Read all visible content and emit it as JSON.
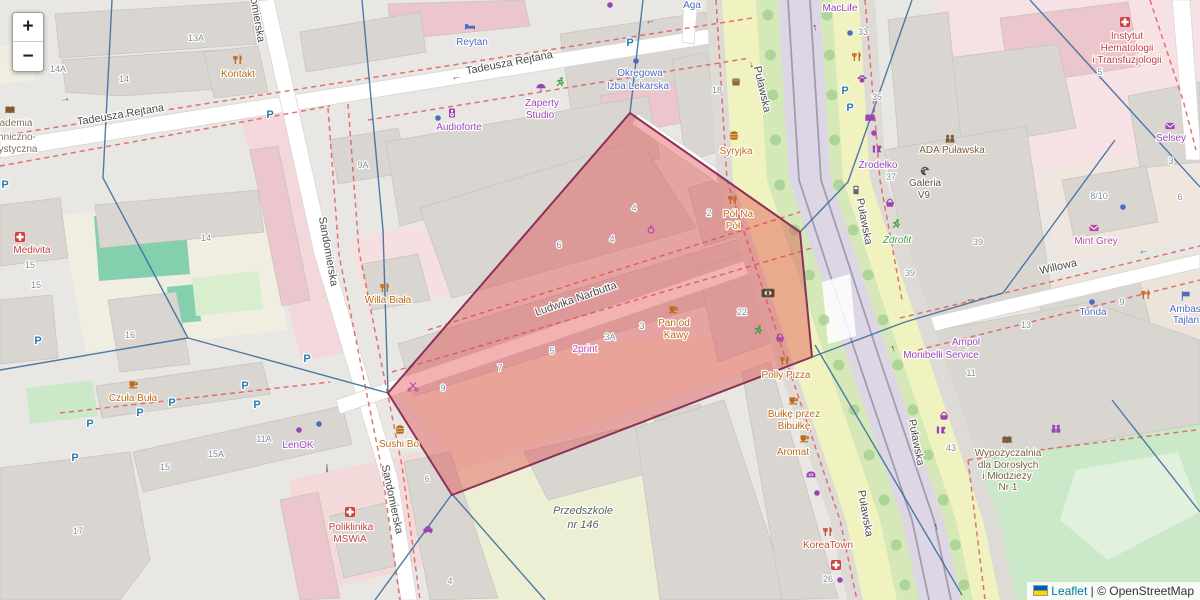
{
  "zoom_control": {
    "zoom_in": "+",
    "zoom_out": "−"
  },
  "attribution": {
    "leaflet": "Leaflet",
    "separator": " | ",
    "copyright": "© OpenStreetMap"
  },
  "colors": {
    "highlight_fill": "#e04848",
    "highlight_stroke": "#8a3157",
    "link": "#0078A8",
    "boundary_red": "#e05c5c",
    "boundary_blue": "#3c6e9e"
  },
  "map": {
    "highlight": {
      "points": "630,113 800,232 812,357 452,495 388,393"
    },
    "street_labels": [
      {
        "text": "Tadeusza Rejtana",
        "x": 121,
        "y": 118,
        "r": -9.5
      },
      {
        "text": "Tadeusza Rejtana",
        "x": 510,
        "y": 66,
        "r": -11
      },
      {
        "text": "Sandomierska",
        "x": 252,
        "y": 8,
        "r": 80
      },
      {
        "text": "Sandomierska",
        "x": 325,
        "y": 252,
        "r": 80
      },
      {
        "text": "Sandomierska",
        "x": 389,
        "y": 500,
        "r": 78
      },
      {
        "text": "Ludwika Narbutta",
        "x": 577,
        "y": 302,
        "r": -19
      },
      {
        "text": "Puławska",
        "x": 759,
        "y": 90,
        "r": 77
      },
      {
        "text": "Puławska",
        "x": 861,
        "y": 222,
        "r": 79
      },
      {
        "text": "Puławska",
        "x": 913,
        "y": 443,
        "r": 79
      },
      {
        "text": "Puławska",
        "x": 862,
        "y": 514,
        "r": 80
      },
      {
        "text": "Willowa",
        "x": 1059,
        "y": 270,
        "r": -13
      }
    ],
    "poi_labels": [
      {
        "text": "Kontakt",
        "x": 238,
        "y": 77,
        "c": "#bc6a14"
      },
      {
        "text": "Syryjka",
        "x": 736,
        "y": 154,
        "c": "#bc6a14"
      },
      {
        "text": "Willa Biała",
        "x": 388,
        "y": 303,
        "c": "#bc6a14"
      },
      {
        "text": "Czuła Buła",
        "x": 133,
        "y": 401,
        "c": "#bc6a14"
      },
      {
        "text": "Sushi Bo",
        "x": 399,
        "y": 447,
        "c": "#bc6a14"
      },
      {
        "text": "Pan od",
        "x": 674,
        "y": 326,
        "c": "#bc6a14"
      },
      {
        "text": "Kawy",
        "x": 676,
        "y": 338,
        "c": "#bc6a14"
      },
      {
        "text": "Pół Na",
        "x": 738,
        "y": 217,
        "c": "#bc6a14"
      },
      {
        "text": "Pół",
        "x": 733,
        "y": 229,
        "c": "#bc6a14"
      },
      {
        "text": "Polly Pizza",
        "x": 786,
        "y": 378,
        "c": "#bc6a14"
      },
      {
        "text": "Bułkę przez",
        "x": 794,
        "y": 417,
        "c": "#bc6a14"
      },
      {
        "text": "Bibułkę",
        "x": 794,
        "y": 429,
        "c": "#bc6a14"
      },
      {
        "text": "Aromat",
        "x": 793,
        "y": 455,
        "c": "#bc6a14"
      },
      {
        "text": "KoreaTown",
        "x": 828,
        "y": 548,
        "c": "#c44f2e"
      },
      {
        "text": "Reytan",
        "x": 472,
        "y": 45,
        "c": "#4d6bbf"
      },
      {
        "text": "Aga",
        "x": 692,
        "y": 8,
        "c": "#4d6bbf"
      },
      {
        "text": "Okręgowa",
        "x": 640,
        "y": 76,
        "c": "#4d6bbf"
      },
      {
        "text": "Izba Lekarska",
        "x": 638,
        "y": 89,
        "c": "#4d6bbf"
      },
      {
        "text": "Tonda",
        "x": 1093,
        "y": 315,
        "c": "#4d6bbf"
      },
      {
        "text": "Ambasa",
        "x": 1188,
        "y": 312,
        "c": "#4d6bbf"
      },
      {
        "text": "Tajlan",
        "x": 1186,
        "y": 323,
        "c": "#4d6bbf"
      },
      {
        "text": "Zaperty",
        "x": 542,
        "y": 106,
        "c": "#9d44b5"
      },
      {
        "text": "Studio",
        "x": 540,
        "y": 118,
        "c": "#9d44b5"
      },
      {
        "text": "Audioforte",
        "x": 459,
        "y": 130,
        "c": "#9d44b5"
      },
      {
        "text": "MacLife",
        "x": 840,
        "y": 11,
        "c": "#9d44b5"
      },
      {
        "text": "Źrodełko",
        "x": 878,
        "y": 168,
        "c": "#9d44b5"
      },
      {
        "text": "LenOK",
        "x": 298,
        "y": 448,
        "c": "#9d44b5"
      },
      {
        "text": "2print",
        "x": 585,
        "y": 352,
        "c": "#c243ad"
      },
      {
        "text": "Selsey",
        "x": 1171,
        "y": 141,
        "c": "#9d44b5"
      },
      {
        "text": "Mint Grey",
        "x": 1096,
        "y": 244,
        "c": "#bb4a9e"
      },
      {
        "text": "Ampol",
        "x": 966,
        "y": 345,
        "c": "#9d44b5"
      },
      {
        "text": "Monibelli Service",
        "x": 941,
        "y": 358,
        "c": "#9d44b5"
      },
      {
        "text": "Medivita",
        "x": 32,
        "y": 253,
        "c": "#c33c3c"
      },
      {
        "text": "Poliklinika",
        "x": 351,
        "y": 530,
        "c": "#c33c3c"
      },
      {
        "text": "MSWiA",
        "x": 350,
        "y": 542,
        "c": "#c33c3c"
      },
      {
        "text": "Instytut",
        "x": 1127,
        "y": 39,
        "c": "#c33c3c"
      },
      {
        "text": "Hematologii",
        "x": 1127,
        "y": 51,
        "c": "#c33c3c"
      },
      {
        "text": "i Transfuzjologii",
        "x": 1127,
        "y": 63,
        "c": "#c33c3c"
      },
      {
        "text": "Zdrofit",
        "x": 897,
        "y": 243,
        "c": "#3da03d",
        "i": true
      },
      {
        "text": "ADA Puławska",
        "x": 952,
        "y": 153,
        "c": "#7d5b35"
      },
      {
        "text": "Wypożyczalnia",
        "x": 1008,
        "y": 456,
        "c": "#77603f"
      },
      {
        "text": "dla Dorosłych",
        "x": 1008,
        "y": 468,
        "c": "#77603f"
      },
      {
        "text": "i Młodzieży",
        "x": 1007,
        "y": 479,
        "c": "#77603f"
      },
      {
        "text": "Nr 1",
        "x": 1008,
        "y": 490,
        "c": "#77603f"
      },
      {
        "text": "Galeria",
        "x": 925,
        "y": 186,
        "c": "#5b5047"
      },
      {
        "text": "V9",
        "x": 924,
        "y": 198,
        "c": "#5b5047"
      },
      {
        "text": "Przedszkole",
        "x": 583,
        "y": 514,
        "c": "#55645c",
        "i": true,
        "s": 11
      },
      {
        "text": "nr 146",
        "x": 583,
        "y": 528,
        "c": "#55645c",
        "i": true,
        "s": 11
      },
      {
        "text": "ademia",
        "x": 16,
        "y": 126,
        "c": "#80755a"
      },
      {
        "text": "hniczno-",
        "x": 17,
        "y": 140,
        "c": "#80755a"
      },
      {
        "text": "ystyczna",
        "x": 18,
        "y": 152,
        "c": "#80755a"
      }
    ],
    "house_numbers": [
      {
        "text": "13A",
        "x": 196,
        "y": 41
      },
      {
        "text": "14A",
        "x": 58,
        "y": 72
      },
      {
        "text": "14",
        "x": 124,
        "y": 82
      },
      {
        "text": "9A",
        "x": 363,
        "y": 168
      },
      {
        "text": "14",
        "x": 206,
        "y": 241
      },
      {
        "text": "15",
        "x": 30,
        "y": 268
      },
      {
        "text": "15",
        "x": 36,
        "y": 288
      },
      {
        "text": "16",
        "x": 130,
        "y": 338
      },
      {
        "text": "15",
        "x": 165,
        "y": 470
      },
      {
        "text": "15A",
        "x": 216,
        "y": 457
      },
      {
        "text": "11A",
        "x": 264,
        "y": 442
      },
      {
        "text": "17",
        "x": 78,
        "y": 534
      },
      {
        "text": "18",
        "x": 717,
        "y": 93
      },
      {
        "text": "2",
        "x": 709,
        "y": 216
      },
      {
        "text": "6",
        "x": 559,
        "y": 248
      },
      {
        "text": "4",
        "x": 612,
        "y": 242
      },
      {
        "text": "4",
        "x": 634,
        "y": 211
      },
      {
        "text": "22",
        "x": 742,
        "y": 315
      },
      {
        "text": "3A",
        "x": 610,
        "y": 340
      },
      {
        "text": "3",
        "x": 642,
        "y": 329
      },
      {
        "text": "5",
        "x": 552,
        "y": 354
      },
      {
        "text": "7",
        "x": 500,
        "y": 371
      },
      {
        "text": "9",
        "x": 443,
        "y": 391
      },
      {
        "text": "6",
        "x": 427,
        "y": 482
      },
      {
        "text": "4",
        "x": 450,
        "y": 584
      },
      {
        "text": "33",
        "x": 863,
        "y": 35
      },
      {
        "text": "35",
        "x": 877,
        "y": 100
      },
      {
        "text": "37",
        "x": 891,
        "y": 180
      },
      {
        "text": "39",
        "x": 978,
        "y": 245
      },
      {
        "text": "39",
        "x": 910,
        "y": 276
      },
      {
        "text": "8/10",
        "x": 1099,
        "y": 199
      },
      {
        "text": "6",
        "x": 1180,
        "y": 200
      },
      {
        "text": "3",
        "x": 1171,
        "y": 164
      },
      {
        "text": "5",
        "x": 1100,
        "y": 75
      },
      {
        "text": "9",
        "x": 1122,
        "y": 305
      },
      {
        "text": "13",
        "x": 1026,
        "y": 328
      },
      {
        "text": "11",
        "x": 971,
        "y": 376
      },
      {
        "text": "43",
        "x": 951,
        "y": 451
      },
      {
        "text": "26",
        "x": 828,
        "y": 582
      }
    ],
    "icons": [
      {
        "k": "restaurant",
        "x": 238,
        "y": 60,
        "c": "#bc6a14"
      },
      {
        "k": "restaurant",
        "x": 385,
        "y": 288,
        "c": "#bc6a14"
      },
      {
        "k": "restaurant",
        "x": 733,
        "y": 200,
        "c": "#bc6a14"
      },
      {
        "k": "restaurant",
        "x": 857,
        "y": 57,
        "c": "#bc6a14"
      },
      {
        "k": "restaurant",
        "x": 785,
        "y": 361,
        "c": "#bc6a14"
      },
      {
        "k": "restaurant",
        "x": 828,
        "y": 532,
        "c": "#c44f2e"
      },
      {
        "k": "restaurant",
        "x": 1146,
        "y": 295,
        "c": "#bc6a14"
      },
      {
        "k": "cafe",
        "x": 673,
        "y": 309,
        "c": "#bc6a14"
      },
      {
        "k": "cafe",
        "x": 133,
        "y": 384,
        "c": "#bc6a14"
      },
      {
        "k": "cafe",
        "x": 793,
        "y": 400,
        "c": "#bc6a14"
      },
      {
        "k": "cafe",
        "x": 804,
        "y": 438,
        "c": "#bc6a14"
      },
      {
        "k": "burger",
        "x": 734,
        "y": 136,
        "c": "#bc6a14"
      },
      {
        "k": "burger",
        "x": 400,
        "y": 430,
        "c": "#bc6a14"
      },
      {
        "k": "bed",
        "x": 470,
        "y": 27,
        "c": "#4d6bbf"
      },
      {
        "k": "dot",
        "x": 610,
        "y": 5,
        "c": "#9d44b5"
      },
      {
        "k": "dot",
        "x": 874,
        "y": 133,
        "c": "#9d44b5"
      },
      {
        "k": "dot",
        "x": 817,
        "y": 493,
        "c": "#9d44b5"
      },
      {
        "k": "dot",
        "x": 299,
        "y": 430,
        "c": "#9d44b5"
      },
      {
        "k": "dot",
        "x": 840,
        "y": 580,
        "c": "#9d44b5"
      },
      {
        "k": "dot",
        "x": 850,
        "y": 33,
        "c": "#4d6bbf"
      },
      {
        "k": "dot",
        "x": 636,
        "y": 61,
        "c": "#4d6bbf"
      },
      {
        "k": "dot",
        "x": 438,
        "y": 118,
        "c": "#4d6bbf"
      },
      {
        "k": "dot",
        "x": 1092,
        "y": 302,
        "c": "#4d6bbf"
      },
      {
        "k": "dot",
        "x": 1123,
        "y": 207,
        "c": "#4d6bbf"
      },
      {
        "k": "dot",
        "x": 319,
        "y": 424,
        "c": "#4d6bbf"
      },
      {
        "k": "runner",
        "x": 560,
        "y": 82,
        "c": "#3da03d"
      },
      {
        "k": "runner",
        "x": 896,
        "y": 224,
        "c": "#3da03d"
      },
      {
        "k": "runner",
        "x": 758,
        "y": 330,
        "c": "#3da03d"
      },
      {
        "k": "umbrella",
        "x": 541,
        "y": 88,
        "c": "#9d44b5"
      },
      {
        "k": "speaker",
        "x": 452,
        "y": 113,
        "c": "#9d44b5"
      },
      {
        "k": "book",
        "x": 870,
        "y": 118,
        "c": "#9d44b5"
      },
      {
        "k": "book",
        "x": 10,
        "y": 110,
        "c": "#7d5b35"
      },
      {
        "k": "book",
        "x": 1007,
        "y": 440,
        "c": "#77603f"
      },
      {
        "k": "paw",
        "x": 862,
        "y": 79,
        "c": "#9d44b5"
      },
      {
        "k": "wine",
        "x": 877,
        "y": 150,
        "c": "#9d44b5"
      },
      {
        "k": "wine",
        "x": 941,
        "y": 431,
        "c": "#9d44b5"
      },
      {
        "k": "people",
        "x": 950,
        "y": 139,
        "c": "#7d5b35"
      },
      {
        "k": "people",
        "x": 1056,
        "y": 429,
        "c": "#9d44b5"
      },
      {
        "k": "basket",
        "x": 890,
        "y": 203,
        "c": "#9d44b5"
      },
      {
        "k": "basket",
        "x": 944,
        "y": 416,
        "c": "#9d44b5"
      },
      {
        "k": "basket",
        "x": 780,
        "y": 338,
        "c": "#b14aa0"
      },
      {
        "k": "envelope",
        "x": 1094,
        "y": 228,
        "c": "#bb4a9e"
      },
      {
        "k": "envelope",
        "x": 1170,
        "y": 126,
        "c": "#9d44b5"
      },
      {
        "k": "palette",
        "x": 925,
        "y": 171,
        "c": "#5b5047"
      },
      {
        "k": "scissors",
        "x": 413,
        "y": 386,
        "c": "#c243ad"
      },
      {
        "k": "ring",
        "x": 651,
        "y": 229,
        "c": "#c243ad"
      },
      {
        "k": "bread",
        "x": 811,
        "y": 475,
        "c": "#9d44b5"
      },
      {
        "k": "bank",
        "x": 768,
        "y": 293,
        "c": "#5a4632"
      },
      {
        "k": "cross",
        "x": 836,
        "y": 565,
        "c": "#d23f3f"
      },
      {
        "k": "cross",
        "x": 350,
        "y": 512,
        "c": "#d23f3f"
      },
      {
        "k": "cross",
        "x": 20,
        "y": 237,
        "c": "#d23f3f"
      },
      {
        "k": "cross",
        "x": 1125,
        "y": 22,
        "c": "#d23f3f"
      },
      {
        "k": "monument",
        "x": 327,
        "y": 468,
        "c": "#8a8a8a"
      },
      {
        "k": "shop",
        "x": 736,
        "y": 82,
        "c": "#8a6a3a"
      },
      {
        "k": "flag",
        "x": 1186,
        "y": 296,
        "c": "#4d6bbf"
      },
      {
        "k": "tram",
        "x": 856,
        "y": 190,
        "c": "#666666"
      },
      {
        "k": "car",
        "x": 428,
        "y": 530,
        "c": "#9d44b5"
      },
      {
        "k": "P",
        "x": 270,
        "y": 114
      },
      {
        "k": "P",
        "x": 630,
        "y": 42
      },
      {
        "k": "P",
        "x": 5,
        "y": 184
      },
      {
        "k": "P",
        "x": 38,
        "y": 340
      },
      {
        "k": "P",
        "x": 90,
        "y": 423
      },
      {
        "k": "P",
        "x": 140,
        "y": 412
      },
      {
        "k": "P",
        "x": 172,
        "y": 402
      },
      {
        "k": "P",
        "x": 245,
        "y": 385
      },
      {
        "k": "P",
        "x": 257,
        "y": 404
      },
      {
        "k": "P",
        "x": 75,
        "y": 457
      },
      {
        "k": "P",
        "x": 845,
        "y": 90
      },
      {
        "k": "P",
        "x": 850,
        "y": 107
      },
      {
        "k": "P",
        "x": 307,
        "y": 358
      },
      {
        "k": "arrow",
        "g": "→",
        "x": 65,
        "y": 98,
        "r": -9,
        "c": "#555555"
      },
      {
        "k": "arrow",
        "g": "←",
        "x": 456,
        "y": 76,
        "r": -11,
        "c": "#555555"
      },
      {
        "k": "arrow",
        "g": "←",
        "x": 650,
        "y": 20,
        "r": -10,
        "c": "#555555"
      },
      {
        "k": "arrow",
        "g": "→",
        "x": 753,
        "y": 64,
        "r": 77,
        "c": "#555555"
      },
      {
        "k": "arrow",
        "g": "←",
        "x": 970,
        "y": 298,
        "r": -13,
        "c": "#555555"
      },
      {
        "k": "arrow",
        "g": "←",
        "x": 1143,
        "y": 250,
        "r": -13,
        "c": "#555555"
      },
      {
        "k": "arrow",
        "g": "↑",
        "x": 815,
        "y": 27,
        "r": -10,
        "c": "#444444"
      },
      {
        "k": "arrow",
        "g": "↑",
        "x": 893,
        "y": 348,
        "r": -18,
        "c": "#444444"
      },
      {
        "k": "arrow",
        "g": "↑",
        "x": 936,
        "y": 526,
        "r": -18,
        "c": "#444444"
      }
    ]
  }
}
